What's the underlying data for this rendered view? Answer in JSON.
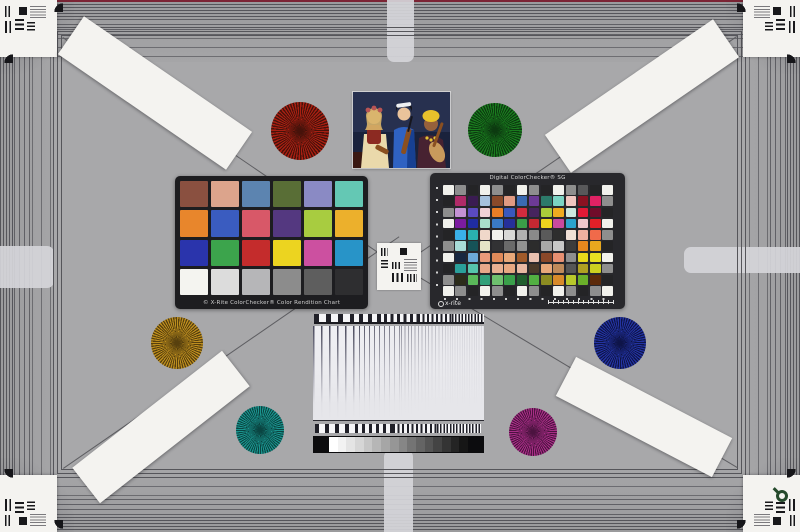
{
  "scene": {
    "name": "camera-resolution-color-test-chart"
  },
  "palette": {
    "field": "#a8a8aa",
    "edge_red": "#7c2434",
    "frame_line": "#55555a",
    "diag_line": "#5e5e62",
    "card": "#f4f3f0",
    "ink": "#18181b",
    "classic_frame": "#1d1d20",
    "sg_frame": "#28282c",
    "loupe": "#254a2c"
  },
  "classic_checker": {
    "caption": "© X-Rite ColorChecker® Color Rendition Chart",
    "rows": [
      [
        "#8a5040",
        "#dca48c",
        "#5c84b0",
        "#596e36",
        "#8a8ac4",
        "#64c8b4"
      ],
      [
        "#e8862c",
        "#3a5cc0",
        "#d85868",
        "#543880",
        "#a8cc40",
        "#ecb02c"
      ],
      [
        "#2a34ac",
        "#3ca44c",
        "#c42c2c",
        "#ecd420",
        "#cc50a0",
        "#2894c8"
      ],
      [
        "#f4f4f0",
        "#dcdcdc",
        "#b6b6b8",
        "#8c8c8c",
        "#5e5e5e",
        "#2e2e30"
      ]
    ]
  },
  "sg_checker": {
    "title": "Digital ColorChecker® SG",
    "logo": "x-rite",
    "rows": [
      [
        "#f1f1ec",
        "#8e8e8e",
        "#242426",
        "#f1f1ec",
        "#8e8e8e",
        "#242426",
        "#f1f1ec",
        "#8e8e8e",
        "#242426",
        "#f1f1ec",
        "#8e8e8e",
        "#58585a",
        "#242426",
        "#f1f1ec"
      ],
      [
        "#242426",
        "#b02a68",
        "#3a1c52",
        "#a6c2de",
        "#8a4a2a",
        "#e09a82",
        "#3a6ab2",
        "#6c3a96",
        "#2c7a6a",
        "#7cd4c4",
        "#f0c6c0",
        "#8a1222",
        "#e02264",
        "#8e8e8e"
      ],
      [
        "#8e8e8e",
        "#c492d4",
        "#5a4ac0",
        "#f0d0d6",
        "#e87e26",
        "#3a58bc",
        "#d02c3e",
        "#46245e",
        "#aacc3a",
        "#eeab20",
        "#cce8de",
        "#e01a36",
        "#700c2a",
        "#242426"
      ],
      [
        "#f1f1ec",
        "#7c1ca0",
        "#202ca2",
        "#a8e0cc",
        "#3a7ac6",
        "#26309a",
        "#3a9e48",
        "#c42832",
        "#ecd41e",
        "#c84a9e",
        "#2ca2cc",
        "#f0c8cc",
        "#e02028",
        "#f1f1ec"
      ],
      [
        "#242426",
        "#3ab0e8",
        "#2ab0b0",
        "#f0d8ca",
        "#f1f1ec",
        "#d8d8d6",
        "#b0b0b0",
        "#8a8a8a",
        "#5a5a5a",
        "#2e2e2e",
        "#f0e0d6",
        "#f0b0a0",
        "#f06a4a",
        "#8e8e8e"
      ],
      [
        "#8e8e8e",
        "#a8dcd8",
        "#165258",
        "#e4e4c6",
        "#323234",
        "#6a6a6a",
        "#929292",
        "#2c2c2c",
        "#a8a8a8",
        "#c8c8c8",
        "#3c3c3c",
        "#e8881e",
        "#e8a81e",
        "#242426"
      ],
      [
        "#f1f1ec",
        "#182840",
        "#6caad8",
        "#e89a7a",
        "#e08a5a",
        "#e8a87a",
        "#a05a2a",
        "#e8c0b0",
        "#8a482a",
        "#e89072",
        "#8e8e8e",
        "#e8d81a",
        "#e8e022",
        "#f1f1ec"
      ],
      [
        "#242426",
        "#2aa09a",
        "#56c4ac",
        "#e8a88a",
        "#e8b092",
        "#e8a882",
        "#e8b8a2",
        "#4a3a2a",
        "#e8a87a",
        "#c08a5a",
        "#565656",
        "#b0a022",
        "#ccd020",
        "#8e8e8e"
      ],
      [
        "#8e8e8e",
        "#2c2c1a",
        "#5ab85a",
        "#32a07a",
        "#6ec06e",
        "#3aa04a",
        "#205e2e",
        "#52b042",
        "#8c8c22",
        "#d88a2a",
        "#b8c82a",
        "#6ab02a",
        "#5c2a0a",
        "#242426"
      ],
      [
        "#f1f1ec",
        "#8e8e8e",
        "#242426",
        "#f1f1ec",
        "#8e8e8e",
        "#242426",
        "#f1f1ec",
        "#8e8e8e",
        "#242426",
        "#f1f1ec",
        "#8e8e8e",
        "#242426",
        "#8e8e8e",
        "#f1f1ec"
      ]
    ]
  },
  "starbursts": [
    {
      "name": "red-starburst",
      "x": 300,
      "y": 131,
      "r": 29,
      "color": "#a81f12",
      "dark": "#46120a"
    },
    {
      "name": "green-starburst",
      "x": 495,
      "y": 130,
      "r": 27,
      "color": "#1a7c1e",
      "dark": "#0c3a10"
    },
    {
      "name": "gold-starburst",
      "x": 177,
      "y": 343,
      "r": 26,
      "color": "#bd8e1e",
      "dark": "#57400e"
    },
    {
      "name": "blue-starburst",
      "x": 620,
      "y": 343,
      "r": 26,
      "color": "#2333a2",
      "dark": "#0e1448"
    },
    {
      "name": "teal-starburst",
      "x": 260,
      "y": 430,
      "r": 24,
      "color": "#1a948e",
      "dark": "#0a4542"
    },
    {
      "name": "magenta-starburst",
      "x": 533,
      "y": 432,
      "r": 24,
      "color": "#a82e86",
      "dark": "#4c1340"
    }
  ],
  "strips": [
    {
      "name": "resolution-strip-top-left",
      "cx": 155,
      "cy": 93,
      "angle": 34.5,
      "len": 204,
      "w": 46,
      "units": 4
    },
    {
      "name": "resolution-strip-top-right",
      "cx": 642,
      "cy": 96,
      "angle": -34.5,
      "len": 204,
      "w": 46,
      "units": 4
    },
    {
      "name": "resolution-strip-bottom-left",
      "cx": 161,
      "cy": 427,
      "angle": -38,
      "len": 190,
      "w": 45,
      "units": 4
    },
    {
      "name": "resolution-strip-bottom-right",
      "cx": 644,
      "cy": 417,
      "angle": 27.5,
      "len": 176,
      "w": 44,
      "units": 4
    }
  ],
  "sweep": {
    "steps": [
      "#ffffff",
      "#f2f2f2",
      "#e4e4e4",
      "#d6d6d6",
      "#c6c6c6",
      "#b6b6b6",
      "#a6a6a6",
      "#969696",
      "#868686",
      "#747474",
      "#646464",
      "#545454",
      "#444444",
      "#343434",
      "#242424",
      "#161616"
    ]
  },
  "photo": {
    "colors": {
      "bg": "#27304f",
      "bg2": "#11182e",
      "floor": "#3a1812",
      "w1_dress": "#ead9ab",
      "w1_bodice": "#8c2a22",
      "w1_skin": "#eac39b",
      "w1_hair": "#d8b468",
      "w1_flowers": "#b85454",
      "w2_coat": "#2f62c2",
      "w2_coat2": "#174092",
      "w2_hair": "#16161e",
      "w2_band": "#eef0f2",
      "violin": "#8a4f20",
      "w3_skin": "#96613c",
      "w3_turban": "#e7c12b",
      "w3_dress": "#472231",
      "lute": "#c89a5c",
      "beads": "#e3c235"
    }
  }
}
